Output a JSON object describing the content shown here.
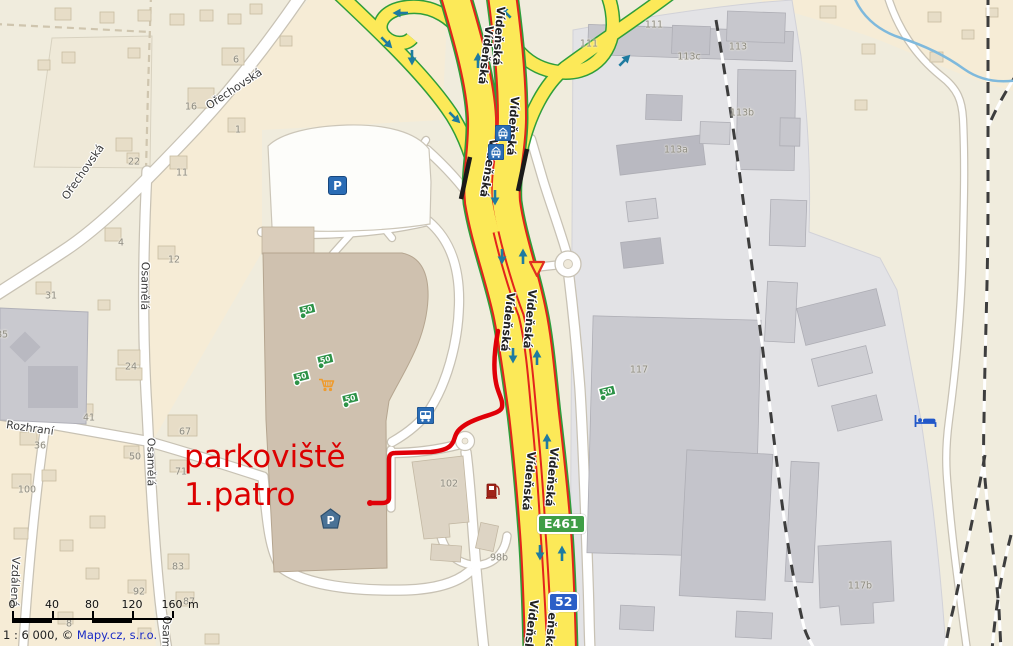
{
  "annotation": {
    "line1": "parkoviště",
    "line2": "1.patro"
  },
  "shields": {
    "e_route": "E461",
    "road_52": "52"
  },
  "streets": {
    "videnska": "Vídeňská",
    "orechovska": "Ořechovská",
    "osamela": "Osamělá",
    "rozhrani": "Rozhraní",
    "vzdalena": "Vzdálená"
  },
  "buildings": {
    "n1": "1",
    "n4": "4",
    "n6": "6",
    "n8": "8",
    "n11": "11",
    "n12": "12",
    "n16": "16",
    "n22": "22",
    "n24": "24",
    "n31": "31",
    "n36": "36",
    "n41": "41",
    "n50": "50",
    "n67": "67",
    "n71": "71",
    "n83": "83",
    "n85": "85",
    "n87": "87",
    "n92": "92",
    "n100": "100",
    "n102": "102",
    "n98b": "98b",
    "n111": "111",
    "n113": "113",
    "n113a": "113a",
    "n113b": "113b",
    "n113c": "113c",
    "n117": "117",
    "n117b": "117b"
  },
  "icons": {
    "parking_letter": "P",
    "money_value": "50"
  },
  "scalebar": {
    "ticks": [
      "0",
      "40",
      "80",
      "120",
      "160"
    ],
    "unit": "m"
  },
  "attribution": {
    "scale_text": "1 : 6 000, ©",
    "link_text": "Mapy.cz, s.r.o."
  },
  "colors": {
    "road_yellow": "#fce958",
    "road_red_line": "#e3241b",
    "ramp_green": "#2f9e3b",
    "route_red": "#e00008",
    "annotation_red": "#dc0000",
    "shield_green": "#3f9e46",
    "shield_blue": "#2b5fc7",
    "icon_blue": "#2a6cb5",
    "industrial_gray": "#e3e3e6",
    "building_gray": "#c7c7cd",
    "mall_taupe": "#cfc1af",
    "water_blue": "#7fb9dc",
    "rail_dark": "#3d3d3d",
    "background": "#f0ecdd"
  }
}
